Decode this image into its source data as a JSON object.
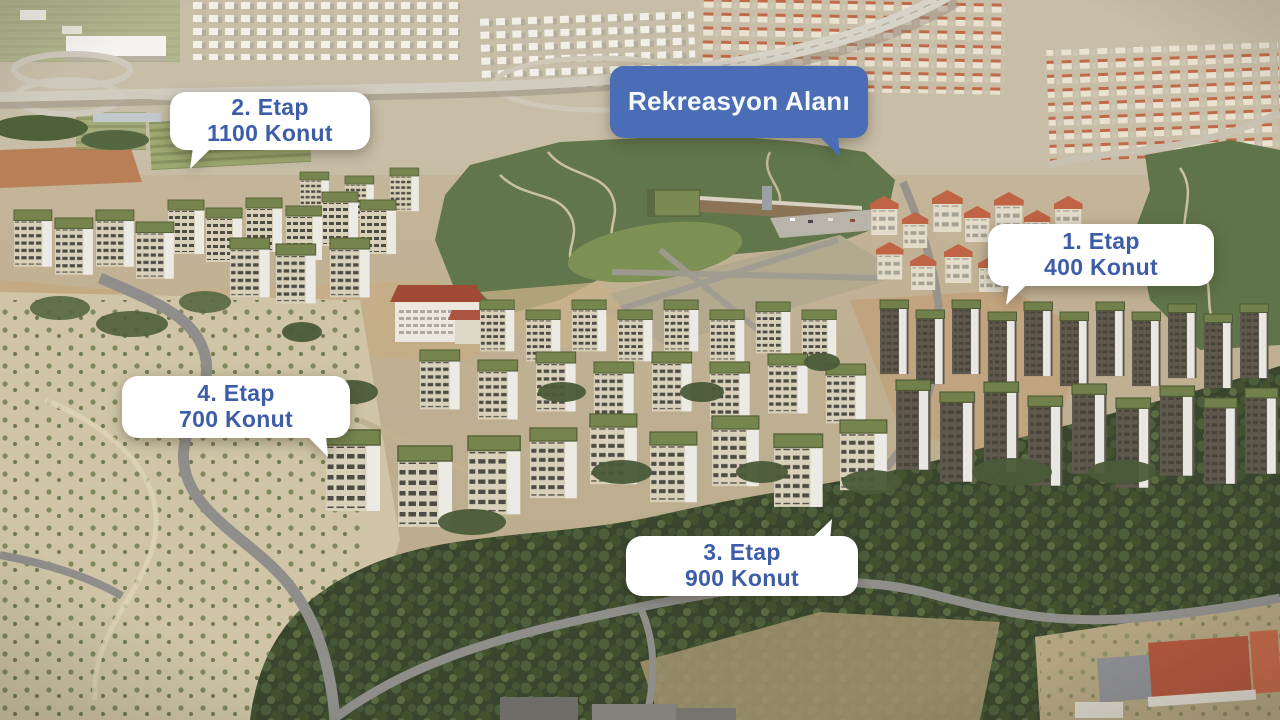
{
  "callouts": {
    "etap1": {
      "line1": "1. Etap",
      "line2": "400 Konut"
    },
    "etap2": {
      "line1": "2. Etap",
      "line2": "1100 Konut"
    },
    "etap3": {
      "line1": "3. Etap",
      "line2": "900 Konut"
    },
    "etap4": {
      "line1": "4. Etap",
      "line2": "700 Konut"
    },
    "rekreasyon": {
      "label": "Rekreasyon Alanı"
    }
  },
  "colors": {
    "bubble_white": "#ffffff",
    "bubble_blue": "#4a6db5",
    "text_blue": "#3d5da9",
    "text_white": "#f6f9fd"
  }
}
